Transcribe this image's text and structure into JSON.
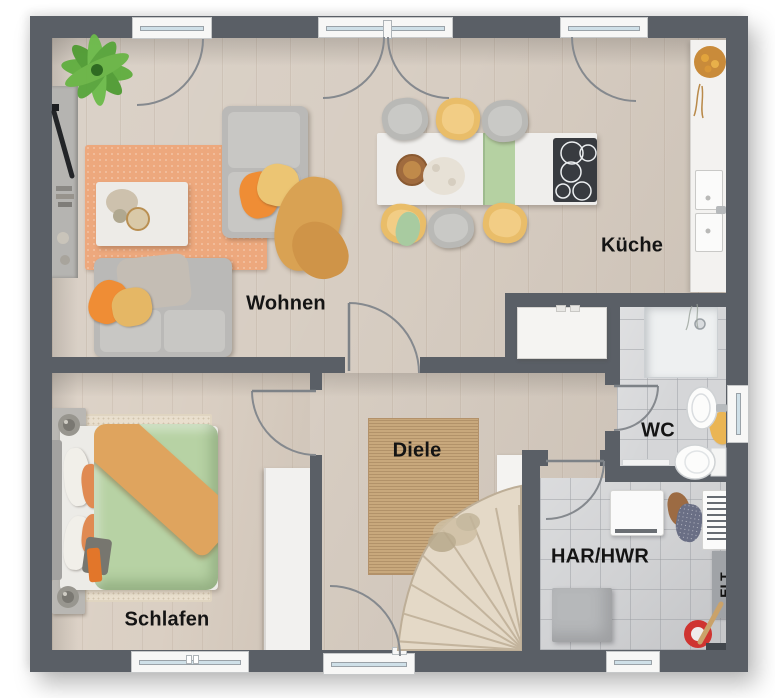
{
  "meta": {
    "type": "floor-plan",
    "floor": "ground-floor"
  },
  "rooms": {
    "wohnen": {
      "label": "Wohnen"
    },
    "kueche": {
      "label": "Küche"
    },
    "schlafen": {
      "label": "Schlafen"
    },
    "diele": {
      "label": "Diele"
    },
    "wc": {
      "label": "WC"
    },
    "har_hwr": {
      "label": "HAR/HWR"
    },
    "elt": {
      "label": "ELT"
    }
  },
  "colors": {
    "wall": "#5a5f66",
    "wood_floor": "#d7cdc2",
    "tile_floor": "#d5d6d8",
    "accent_orange": "#ef8d35",
    "accent_green_duvet": "#b7d2a4",
    "accent_yellow_chair": "#e9bd69",
    "jute_rug": "#c8a87c",
    "label_text": "#141414"
  }
}
